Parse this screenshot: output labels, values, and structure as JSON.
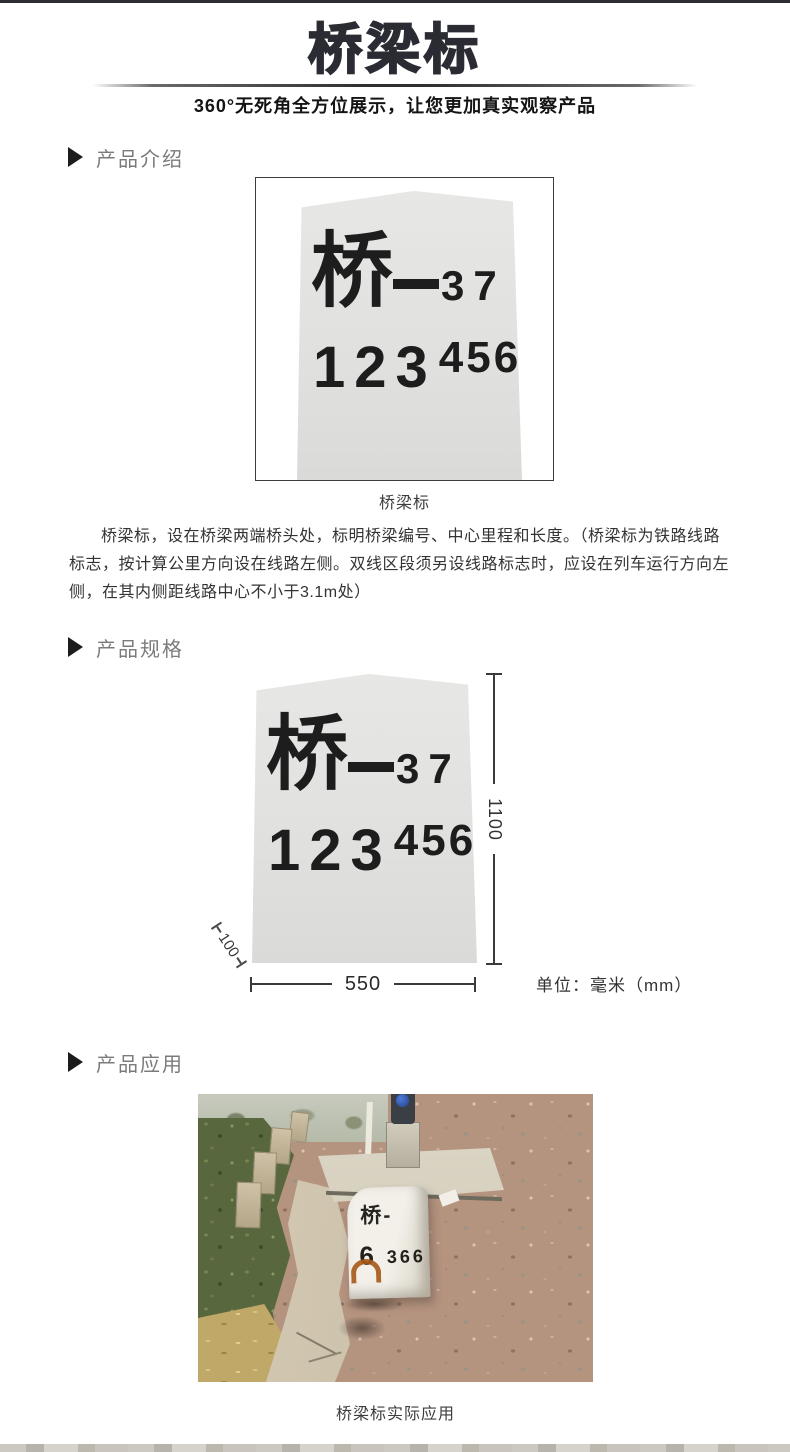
{
  "page": {
    "title": "桥梁标",
    "subtitle": "360°无死角全方位展示，让您更加真实观察产品"
  },
  "sections": {
    "intro_label": "产品介绍",
    "specs_label": "产品规格",
    "application_label": "产品应用"
  },
  "marker_sign": {
    "char": "桥",
    "dash": "—",
    "number_top": "37",
    "number_bottom_main": "123",
    "number_bottom_sup": "456"
  },
  "intro": {
    "caption": "桥梁标",
    "description": "桥梁标，设在桥梁两端桥头处，标明桥梁编号、中心里程和长度。（桥梁标为铁路线路标志，按计算公里方向设在线路左侧。双线区段须另设线路标志时，应设在列车运行方向左侧，在其内侧距线路中心不小于3.1m处）"
  },
  "specs": {
    "height_label": "1100",
    "width_label": "550",
    "depth_label": "100",
    "unit_label": "单位：毫米（mm）"
  },
  "application": {
    "caption": "桥梁标实际应用",
    "photo_marker_line1": "桥-",
    "photo_marker_big": "6",
    "photo_marker_small": "366"
  },
  "colors": {
    "title_dark": "#2b2b33",
    "section_text": "#7b7b7b",
    "body_text": "#333333",
    "stone_fill": "#e2e2e0",
    "rust": "#a85816"
  }
}
